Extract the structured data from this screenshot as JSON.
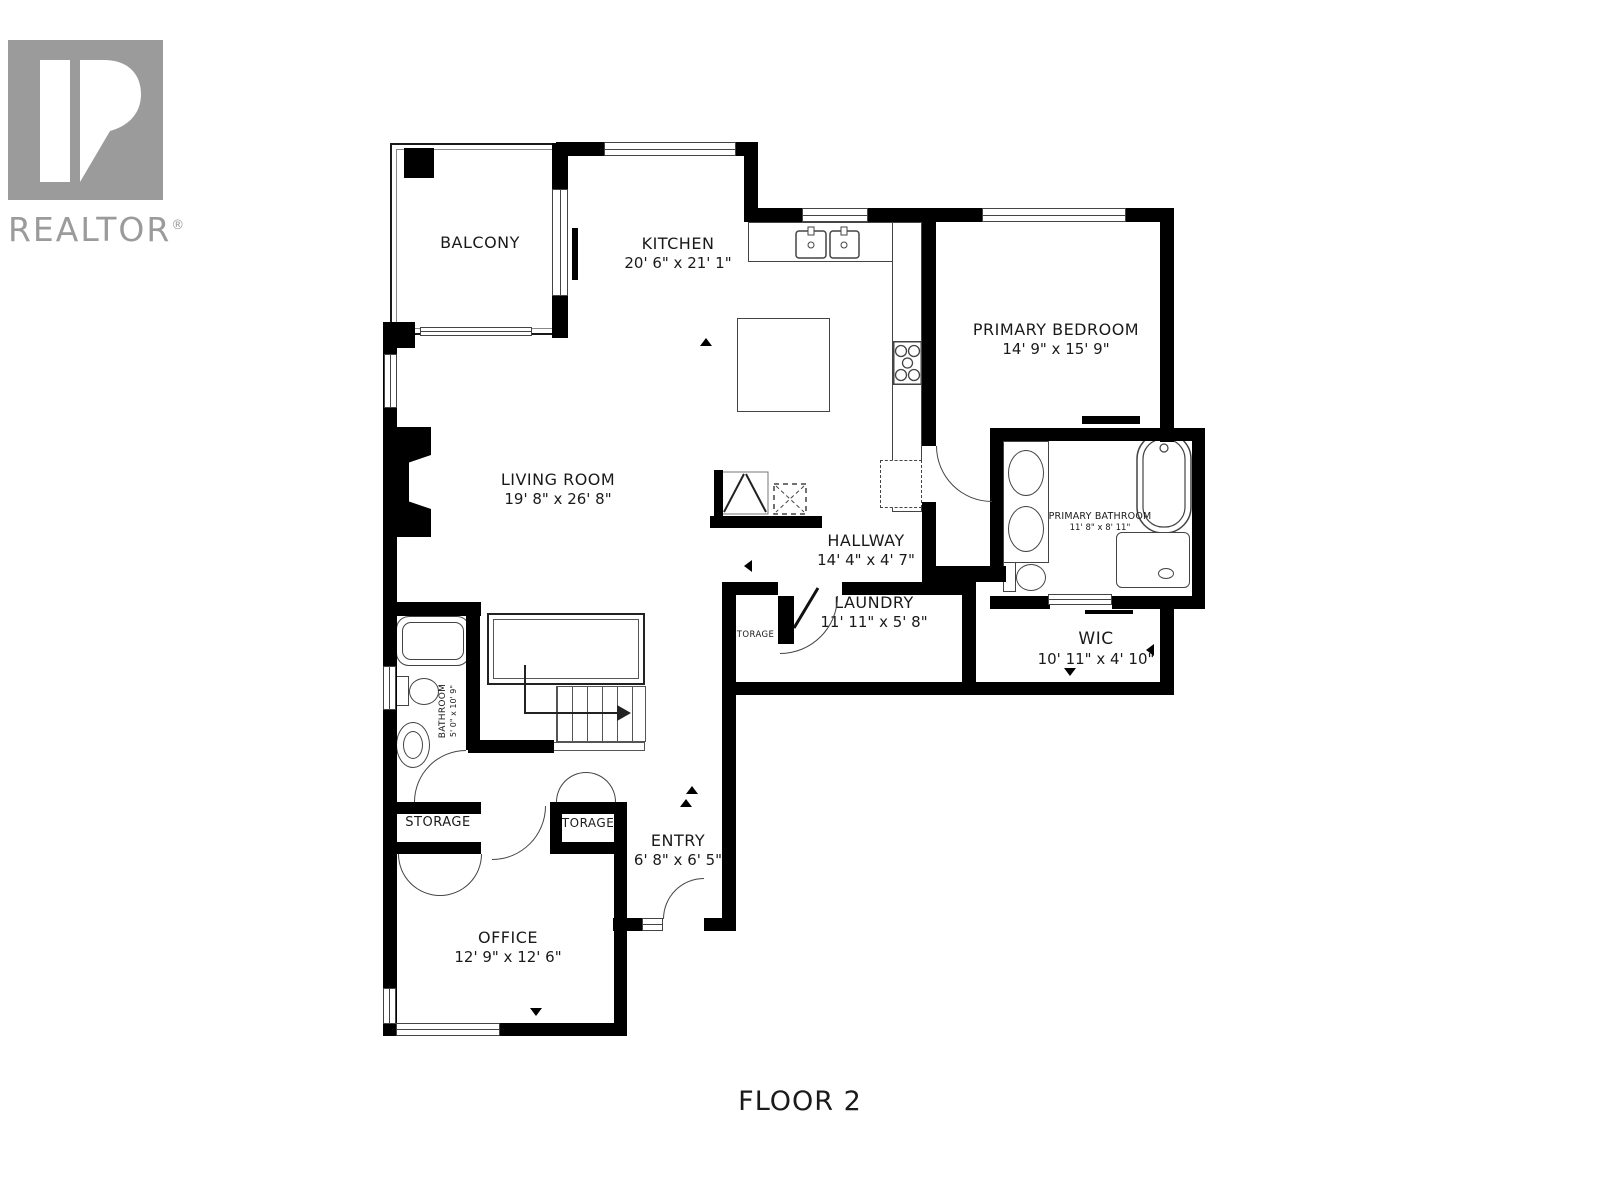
{
  "logo": {
    "brand": "REALTOR",
    "registered_mark": "®"
  },
  "floor_title": "FLOOR 2",
  "rooms": {
    "balcony": {
      "label": "BALCONY",
      "dims": ""
    },
    "kitchen": {
      "label": "KITCHEN",
      "dims": "20' 6\" x 21' 1\""
    },
    "primary_bedroom": {
      "label": "PRIMARY BEDROOM",
      "dims": "14' 9\" x 15' 9\""
    },
    "living_room": {
      "label": "LIVING ROOM",
      "dims": "19' 8\" x 26' 8\""
    },
    "hallway": {
      "label": "HALLWAY",
      "dims": "14' 4\" x 4' 7\""
    },
    "laundry": {
      "label": "LAUNDRY",
      "dims": "11' 11\" x 5' 8\""
    },
    "primary_bathroom": {
      "label": "PRIMARY BATHROOM",
      "dims": "11' 8\" x 8' 11\""
    },
    "wic": {
      "label": "WIC",
      "dims": "10' 11\" x 4' 10\""
    },
    "bathroom": {
      "label": "BATHROOM",
      "dims": "5' 0\" x 10' 9\""
    },
    "storage_hall": {
      "label": "STORAGE",
      "dims": ""
    },
    "storage_laundry": {
      "label": "STORAGE",
      "dims": ""
    },
    "storage_entry": {
      "label": "STORAGE",
      "dims": ""
    },
    "entry": {
      "label": "ENTRY",
      "dims": "6' 8\" x 6' 5\""
    },
    "office": {
      "label": "OFFICE",
      "dims": "12' 9\" x 12' 6\""
    }
  },
  "colors": {
    "wall": "#000000",
    "fixture_line": "#444444",
    "logo_gray": "#9b9b9b",
    "text": "#1a1a1a",
    "background": "#ffffff"
  }
}
